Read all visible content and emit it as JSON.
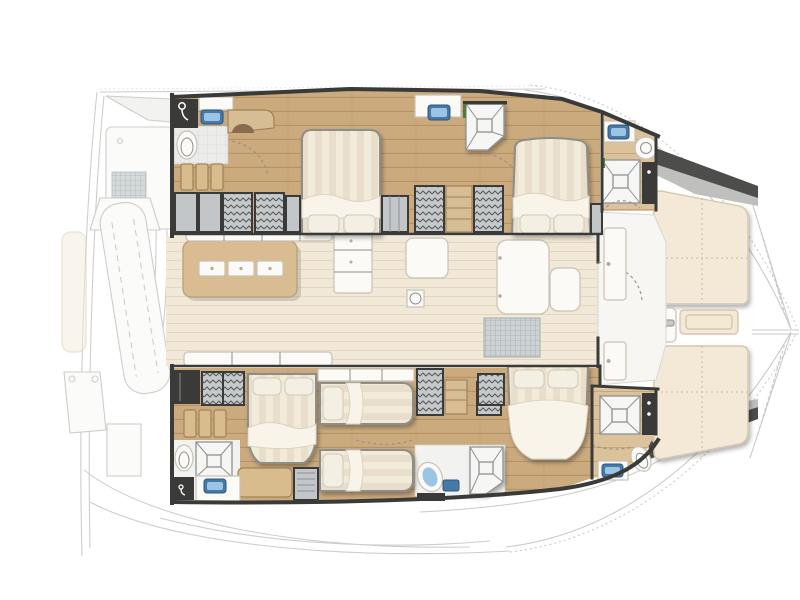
{
  "figure": {
    "kind": "catamaran-floorplan",
    "view": "top-down",
    "orientation": "bow-right-stern-left",
    "hulls": 2,
    "cabin_count": 5
  },
  "palette": {
    "bg": "#ffffff",
    "wall": "#3a3a38",
    "hullFloor": "#cbaa7e",
    "hullFloorLight": "#dcc29b",
    "saloonFloor": "#f1e8d7",
    "saloonLine": "#e3d7c1",
    "table": "#d9bc92",
    "duvet": "#e8decb",
    "duvetStripe": "#f3ebda",
    "pillow": "#f4efe3",
    "white": "#fbfaf6",
    "furnitureLine": "#c9c2b4",
    "locker": "#c3c6c8",
    "lockerLine": "#54585a",
    "shelf": "#d6bd94",
    "woodStep": "#d9bc8e",
    "sink": "#4679a8",
    "sinkLight": "#9cc4e4",
    "shower": "#f6f6f4",
    "showerLine": "#8d9193",
    "cream": "#f3e9d6",
    "creamEdge": "#d5c7ad",
    "ghostLine": "#c4c4c2",
    "ghostFill": "#f0f0ee",
    "green": "#4f7d3c",
    "metal": "#c9c9c7"
  },
  "regions": {
    "aft_deck": {
      "label": "aft deck / transom (ghosted sketch)",
      "items": [
        "helm-station",
        "dinghy-on-davits",
        "cockpit-hatches",
        "transom-steps",
        "stern-bench"
      ]
    },
    "starboard_hull": {
      "label": "starboard hull (top)",
      "compartments": [
        {
          "name": "aft-head",
          "fixtures": [
            "shower-cabin",
            "washbasin",
            "toilet",
            "vanity-desk",
            "companionway-steps",
            "hanging-lockers"
          ]
        },
        {
          "name": "midship-double-cabin",
          "fixtures": [
            "double-bed",
            "washbasin",
            "side-lockers"
          ]
        },
        {
          "name": "wardrobe-passage",
          "fixtures": [
            "hanging-locker",
            "shelf-unit",
            "hanging-locker",
            "shower-tray"
          ]
        },
        {
          "name": "forward-double-cabin",
          "fixtures": [
            "double-bed",
            "side-locker"
          ]
        },
        {
          "name": "forward-head",
          "fixtures": [
            "washbasin",
            "toilet",
            "shower-tray",
            "tall-locker"
          ]
        }
      ]
    },
    "saloon": {
      "label": "saloon and galley (center)",
      "items": [
        "galley-island",
        "burner-plates",
        "aft-sofa",
        "galley-counter",
        "fridge-unit",
        "deck-socket",
        "nav-module",
        "nav-seat",
        "floor-mat",
        "aft-settee",
        "foredeck-doors",
        "deck-hatch"
      ]
    },
    "port_hull": {
      "label": "port hull (bottom)",
      "compartments": [
        {
          "name": "aft-double-cabin",
          "fixtures": [
            "double-bed",
            "hanging-locker",
            "dark-locker",
            "bench",
            "vent-locker"
          ]
        },
        {
          "name": "aft-head",
          "fixtures": [
            "companionway-steps",
            "shower-tray",
            "toilet",
            "washbasin",
            "dark-locker"
          ]
        },
        {
          "name": "midship-twin-cabin",
          "fixtures": [
            "single-bed",
            "single-bed",
            "shelf-row",
            "hanging-locker",
            "shelf-unit",
            "hanging-locker"
          ]
        },
        {
          "name": "mid-head",
          "fixtures": [
            "shower-tray",
            "pedestal-washbasin",
            "mirror",
            "dark-locker"
          ]
        },
        {
          "name": "forward-double-cabin",
          "fixtures": [
            "double-bed",
            "hanging-locker"
          ]
        },
        {
          "name": "forward-head",
          "fixtures": [
            "shower-tray",
            "washbasin",
            "toilet",
            "tall-locker"
          ]
        }
      ]
    },
    "foredeck": {
      "label": "foredeck / bow (right)",
      "items": [
        "sunpad-starboard",
        "sunpad-port",
        "deck-hatch",
        "winch",
        "bow-steps",
        "anchor-locker-walls",
        "trampoline",
        "bow-point"
      ]
    }
  },
  "counts": {
    "double_beds": 4,
    "single_beds": 2,
    "shower_trays": 6,
    "washbasins": 6,
    "sunpads": 2
  }
}
